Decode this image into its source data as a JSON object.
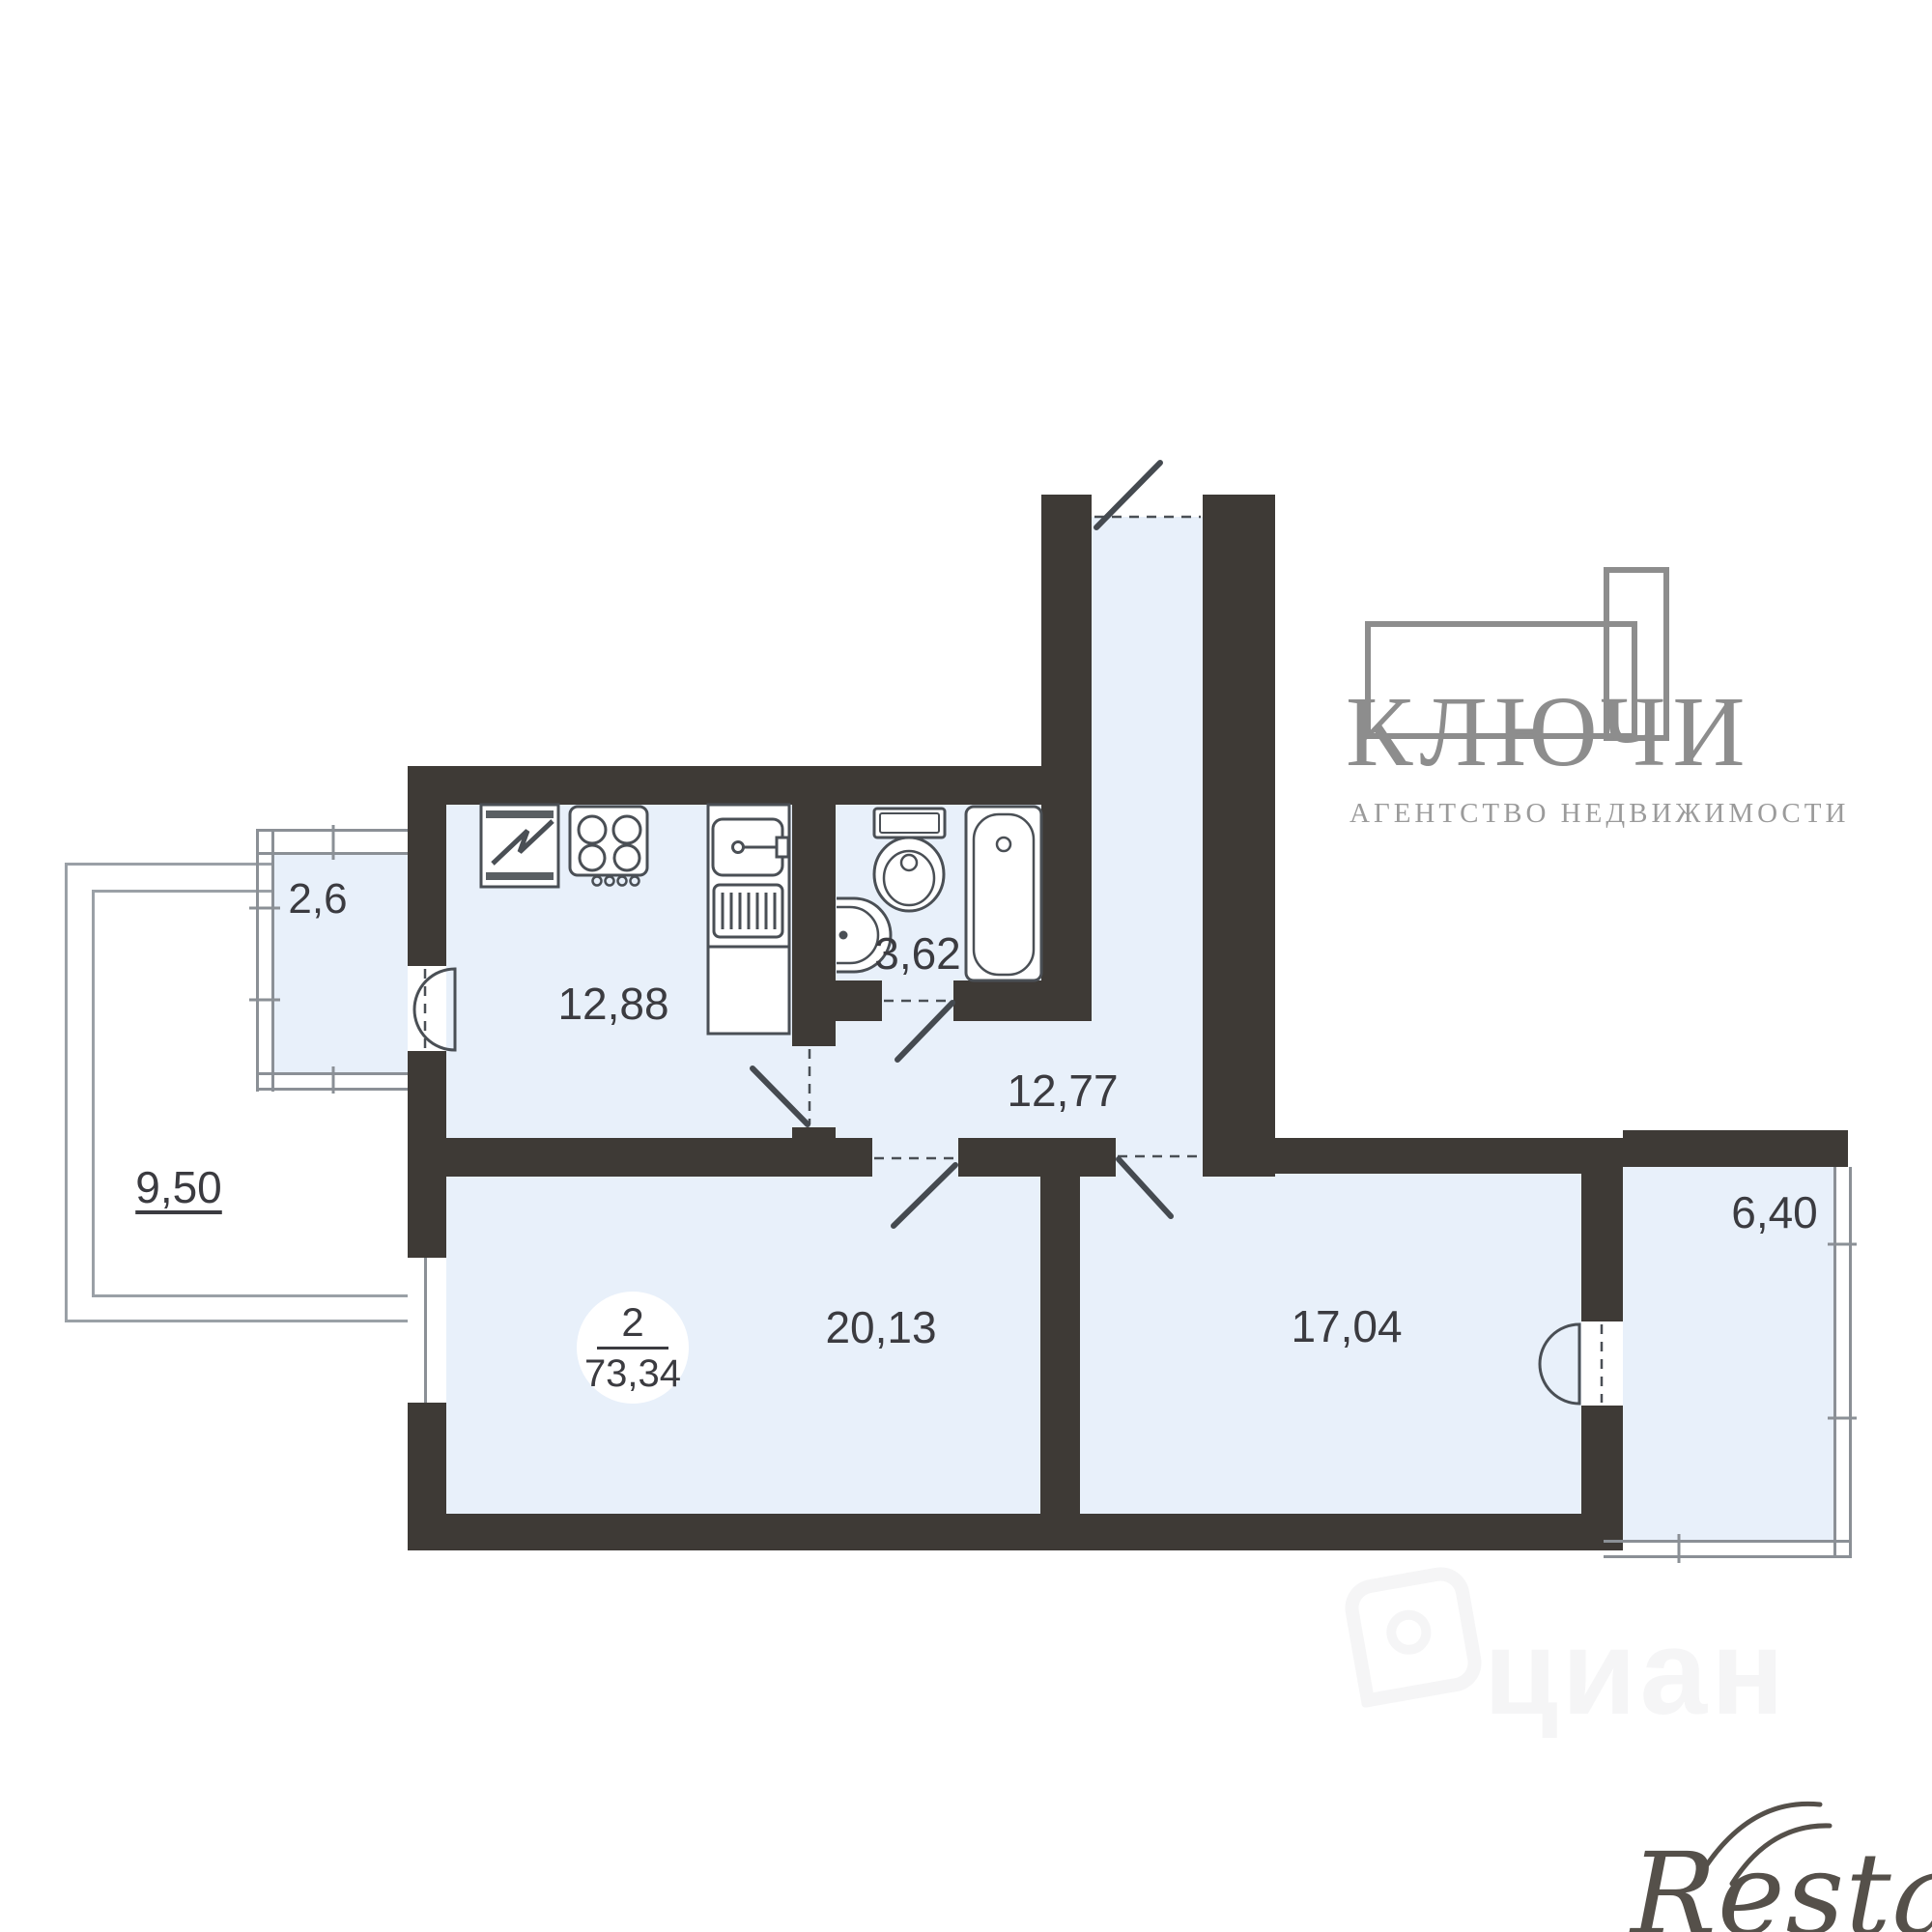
{
  "plan": {
    "badge": {
      "rooms": "2",
      "total_area": "73,34"
    },
    "labels": {
      "kitchen": "12,88",
      "bathroom": "3,62",
      "hallway": "12,77",
      "living_room": "20,13",
      "bedroom": "17,04",
      "balcony_small": "2,6",
      "terrace": "9,50",
      "balcony_right": "6,40"
    }
  },
  "branding": {
    "agency_name": "КЛЮЧИ",
    "agency_subtitle": "АГЕНТСТВО НЕДВИЖИМОСТИ",
    "watermark_cian": "циан",
    "watermark_restate": "Restate"
  },
  "colors": {
    "wall": "#3e3a36",
    "room_fill": "#e8f0fa",
    "fixture_line": "#4a4f55",
    "glazing_line": "#8b9096",
    "terrace_line": "#9aa0a6",
    "label_text": "#3b3b40",
    "logo_gray": "#8d8d8d",
    "restate_gray": "#55504a"
  }
}
